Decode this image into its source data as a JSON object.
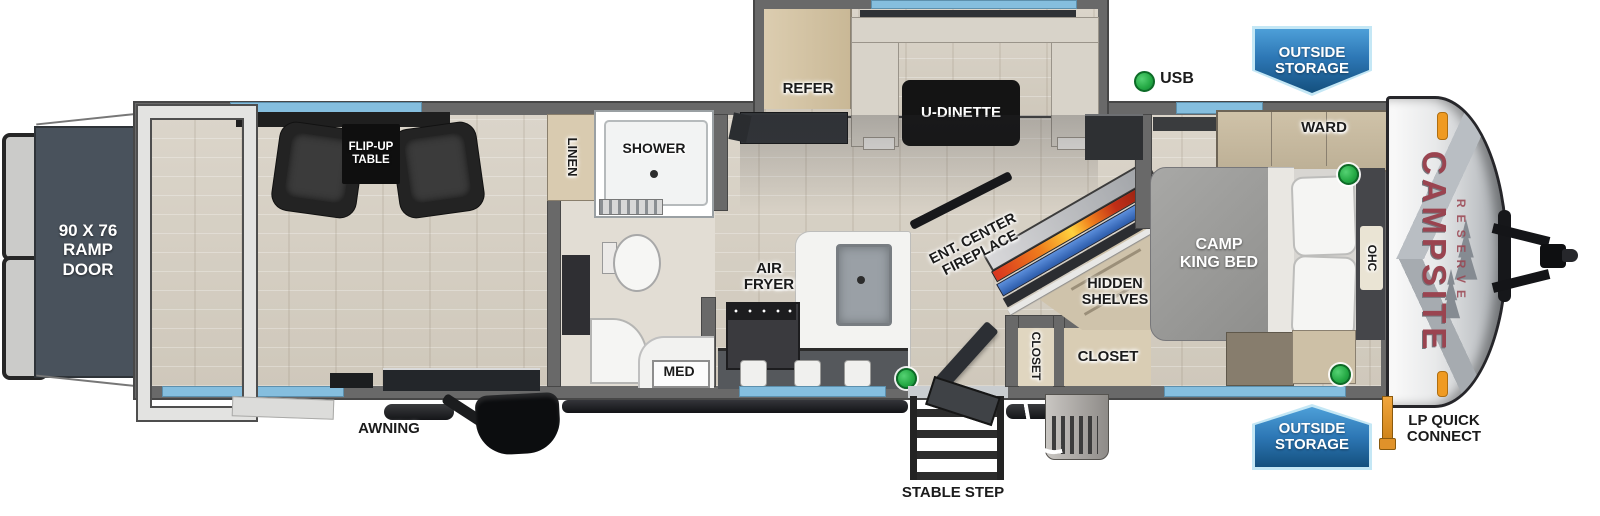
{
  "title": "Campsite Reserve travel trailer floorplan",
  "brand": {
    "name": "CAMPSITE",
    "sub": "RESERVE"
  },
  "labels": {
    "ramp_door": "90 X 76\nRAMP\nDOOR",
    "flip_up_table": "FLIP-UP\nTABLE",
    "awning": "AWNING",
    "linen": "LINEN",
    "shower": "SHOWER",
    "med": "MED",
    "refer": "REFER",
    "u_dinette": "U-DINETTE",
    "air_fryer": "AIR\nFRYER",
    "ent_center_fireplace": "ENT. CENTER\nFIREPLACE",
    "hidden_shelves": "HIDDEN\nSHELVES",
    "closet_entry": "CLOSET",
    "closet_bedroom": "CLOSET",
    "ward": "WARD",
    "camp_king_bed": "CAMP\nKING BED",
    "ohc": "OHC",
    "usb": "USB",
    "stable_step": "STABLE STEP",
    "lp_quick_connect": "LP QUICK\nCONNECT",
    "outside_storage_top": "OUTSIDE\nSTORAGE",
    "outside_storage_bottom": "OUTSIDE\nSTORAGE"
  },
  "colors": {
    "wall_gray": "#696969",
    "wall_dark": "#474747",
    "window_blue": "#85bede",
    "ramp_door": "#49525c",
    "indicator_green": "#23a843",
    "badge_blue_light": "#4d9fd8",
    "badge_blue_dark": "#14507e",
    "brand_red": "#9a4450",
    "fireplace_orange": "#f07f1c",
    "fireplace_blue": "#2c5cab",
    "floor_wood": "#d7d1c6",
    "bath_floor": "#e2ddd4",
    "cabinet_tan": "#d3c3a4"
  }
}
